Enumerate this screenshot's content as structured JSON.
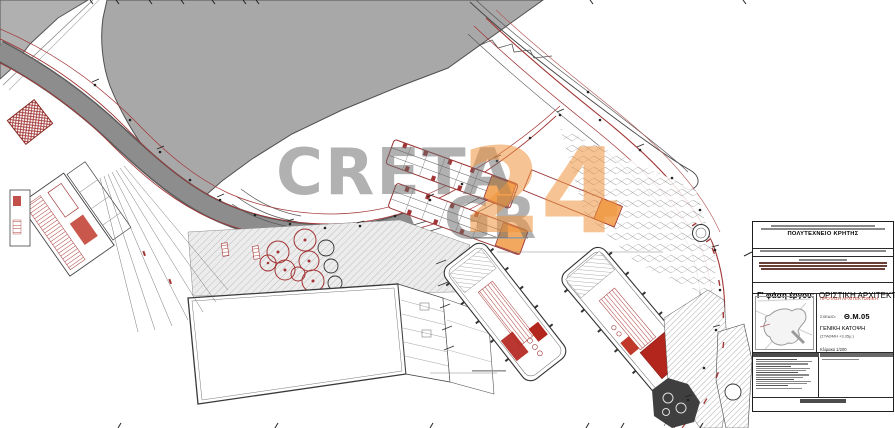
{
  "page": {
    "kind": "architectural-site-plan",
    "description": "General site plan drawing of a harbour waterfront (black/red technical linework, grey land mass, orange roofed piers) with Greek title block and CRETA 24 watermark"
  },
  "watermark": {
    "line1": "CRETA",
    "line2": "GR",
    "number": "24",
    "gray_color": "#696969",
    "orange_color": "#ee943c"
  },
  "title_block": {
    "org": "ΠΟΛΥΤΕΧΝΕΙΟ ΚΡΗΤΗΣ",
    "phase_label": "Γ' φάση έργου:",
    "phase_value": "ΟΡΙΣΤΙΚΗ ΑΡΧΙΤΕΚΤΟΝΙΚΗ ΜΕΛΕΤΗ",
    "proposal": "ΠΡΟΤΑΣΗ ΑΡΧΙΤΕΚΤΟΝΙΚΗ",
    "sheet_label": "ΣΧΕΔΙΟ:",
    "sheet_code": "Θ.Μ.05",
    "sheet_title": "ΓΕΝΙΚΗ ΚΑΤΟΨΗ",
    "sheet_subtitle": "(ΣΤΑΘΜΗ +3.35μ.)",
    "scale": "Κλίμακα 1/200",
    "proposal_color": "#c0392b"
  },
  "drawing_colors": {
    "land_gray": "#a8a8a8",
    "road_gray": "#8d8d8d",
    "red_line": "#a23535",
    "red_fill": "#b3261e",
    "orange_roof": "#f2a85f",
    "hatch_gray": "#bdbdbd"
  }
}
